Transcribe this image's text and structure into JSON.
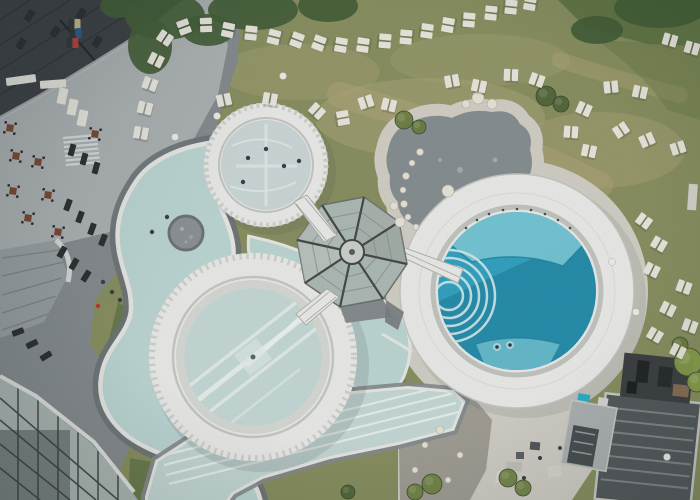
{
  "scene": {
    "title": "Aerial drone view of an alpine spa resort with circular thermal pools",
    "type": "aerial-photograph",
    "elements": "hotel roof and terrace, lazy river with stone island, three round pools, octagonal glass pavilion with footbridges, lap pool, pebble pond, gravel yard, service buildings, lawns with rows of sun loungers"
  },
  "palette": {
    "grassBase": "#8a9162",
    "grassLight": "#aaa67a",
    "grassDark": "#5e7546",
    "canopy": "#45613a",
    "worn": "#b3a97c",
    "gravelLight": "#d3d0c7",
    "gravelDark": "#a29f96",
    "pebbleDark": "#879092",
    "stoneWhite": "#e9e5da",
    "riverWater": "#bed8d5",
    "poolPale": "#c6dad7",
    "upperWater": "#cdd9d9",
    "rimWhite": "#ecedea",
    "rimShade": "#d2d3cf",
    "curbWhite": "#e9eae6",
    "paveDark": "#6f757a",
    "paveMid": "#878d90",
    "terraceLight": "#aeb3b4",
    "roofDark": "#3e4245",
    "roofTile": "#2c3033",
    "glassPane": "#aebbb6",
    "glassDark": "#454b4d",
    "frameDark": "#474c49",
    "deepPool": "#34a4c2",
    "deepLight": "#7ccad8",
    "deepShadow": "#16708c",
    "stepLine": "#d6ecee",
    "loungerWhite": "#eae8df",
    "loungerDark": "#2d3134",
    "tableBrown": "#7b4a32",
    "accentRed": "#c0392b",
    "accentBlue": "#2e5f8a",
    "accentTan": "#c9b98f",
    "accentTeal": "#29b2c9",
    "buildingRoof": "#565b5e",
    "buildingStripe": "#8d9296",
    "annexRoof": "#aeb3b4"
  },
  "counts": {
    "white_loungers": 50,
    "dark_loungers": 13,
    "bistro_tables": 8,
    "round_pools": 3,
    "bridges": 3
  },
  "canopy": [
    [
      165,
      16,
      40,
      24
    ],
    [
      253,
      10,
      45,
      20
    ],
    [
      328,
      6,
      30,
      16
    ],
    [
      660,
      8,
      46,
      20
    ],
    [
      150,
      46,
      22,
      28
    ],
    [
      118,
      6,
      18,
      12
    ],
    [
      597,
      30,
      26,
      14
    ],
    [
      208,
      30,
      26,
      16
    ]
  ],
  "white_loungers": [
    [
      141,
      133,
      10
    ],
    [
      145,
      108,
      14
    ],
    [
      150,
      84,
      20
    ],
    [
      156,
      60,
      26
    ],
    [
      165,
      38,
      34
    ],
    [
      184,
      27,
      70
    ],
    [
      206,
      25,
      88
    ],
    [
      228,
      30,
      -78
    ],
    [
      251,
      33,
      96
    ],
    [
      274,
      37,
      -76
    ],
    [
      297,
      40,
      110
    ],
    [
      319,
      43,
      -70
    ],
    [
      341,
      45,
      100
    ],
    [
      363,
      45,
      -82
    ],
    [
      385,
      41,
      95
    ],
    [
      406,
      37,
      -85
    ],
    [
      427,
      31,
      98
    ],
    [
      448,
      25,
      -80
    ],
    [
      469,
      20,
      95
    ],
    [
      491,
      13,
      -84
    ],
    [
      511,
      7,
      96
    ],
    [
      530,
      3,
      -80
    ],
    [
      452,
      81,
      -10
    ],
    [
      479,
      86,
      12
    ],
    [
      511,
      75,
      2
    ],
    [
      537,
      80,
      20
    ],
    [
      611,
      87,
      -6
    ],
    [
      640,
      92,
      12
    ],
    [
      670,
      40,
      16
    ],
    [
      692,
      48,
      16
    ],
    [
      584,
      109,
      24
    ],
    [
      571,
      132,
      4
    ],
    [
      589,
      151,
      12
    ],
    [
      621,
      130,
      -34
    ],
    [
      647,
      140,
      -24
    ],
    [
      678,
      148,
      -18
    ],
    [
      644,
      221,
      36
    ],
    [
      659,
      244,
      30
    ],
    [
      652,
      270,
      26
    ],
    [
      684,
      287,
      20
    ],
    [
      668,
      309,
      26
    ],
    [
      690,
      326,
      20
    ],
    [
      655,
      335,
      30
    ],
    [
      678,
      351,
      26
    ],
    [
      224,
      100,
      -12
    ],
    [
      270,
      99,
      10
    ],
    [
      317,
      111,
      42
    ],
    [
      343,
      118,
      80
    ],
    [
      366,
      102,
      -18
    ],
    [
      389,
      105,
      14
    ]
  ],
  "dark_loungers": [
    [
      72,
      150,
      15
    ],
    [
      84,
      159,
      15
    ],
    [
      96,
      168,
      15
    ],
    [
      68,
      205,
      20
    ],
    [
      80,
      217,
      20
    ],
    [
      92,
      229,
      20
    ],
    [
      103,
      240,
      22
    ],
    [
      62,
      252,
      30
    ],
    [
      74,
      264,
      30
    ],
    [
      86,
      276,
      32
    ],
    [
      18,
      332,
      70
    ],
    [
      32,
      344,
      64
    ],
    [
      46,
      356,
      58
    ]
  ],
  "bistro_tables": [
    [
      10,
      128
    ],
    [
      95,
      134
    ],
    [
      16,
      156
    ],
    [
      38,
      162
    ],
    [
      13,
      191
    ],
    [
      48,
      195
    ],
    [
      28,
      218
    ],
    [
      58,
      232
    ]
  ],
  "balls": [
    [
      283,
      76
    ],
    [
      217,
      116
    ],
    [
      175,
      137
    ],
    [
      636,
      312
    ],
    [
      612,
      262
    ],
    [
      667,
      457
    ]
  ],
  "stones": [
    [
      420,
      152,
      3.5
    ],
    [
      412,
      163,
      3
    ],
    [
      406,
      176,
      3.5
    ],
    [
      403,
      190,
      3
    ],
    [
      404,
      204,
      3.5
    ],
    [
      408,
      217,
      3
    ],
    [
      416,
      227,
      3
    ],
    [
      448,
      191,
      6
    ],
    [
      400,
      222,
      5
    ],
    [
      394,
      206,
      4
    ],
    [
      478,
      98,
      6
    ],
    [
      492,
      104,
      5
    ],
    [
      466,
      104,
      4
    ],
    [
      440,
      430,
      4
    ],
    [
      425,
      445,
      3
    ],
    [
      460,
      455,
      3
    ],
    [
      415,
      470,
      3
    ],
    [
      448,
      480,
      3
    ]
  ],
  "bushes": [
    [
      404,
      120,
      9,
      "#6e7f43"
    ],
    [
      419,
      127,
      7,
      "#6e7f43"
    ],
    [
      546,
      96,
      10,
      "#55683c"
    ],
    [
      561,
      104,
      8,
      "#55683c"
    ],
    [
      688,
      362,
      14,
      "#8aa04e"
    ],
    [
      697,
      382,
      10,
      "#8aa04e"
    ],
    [
      680,
      345,
      8,
      "#6e7f43"
    ],
    [
      432,
      484,
      10,
      "#748648"
    ],
    [
      415,
      492,
      8,
      "#748648"
    ],
    [
      348,
      492,
      7,
      "#55683c"
    ],
    [
      508,
      478,
      9,
      "#748648"
    ],
    [
      523,
      488,
      8,
      "#748648"
    ]
  ],
  "people": [
    [
      248,
      158,
      "#39424a"
    ],
    [
      266,
      149,
      "#39424a"
    ],
    [
      284,
      166,
      "#39424a"
    ],
    [
      243,
      182,
      "#39424a"
    ],
    [
      299,
      161,
      "#39424a"
    ],
    [
      152,
      232,
      "#39424a"
    ],
    [
      167,
      217,
      "#39424a"
    ],
    [
      497,
      347,
      "swim"
    ],
    [
      510,
      345,
      "swim"
    ],
    [
      103,
      282,
      "#39424a"
    ],
    [
      112,
      292,
      "#39424a"
    ],
    [
      120,
      300,
      "#39424a"
    ],
    [
      98,
      306,
      "#c0392b"
    ]
  ],
  "accent_loungers": [
    [
      76,
      24,
      "#c9b98f"
    ],
    [
      77,
      33,
      "#2e5f8a"
    ],
    [
      74,
      43,
      "#b8453a"
    ]
  ],
  "right_pool": {
    "railing_dots": [
      [
        466,
        228
      ],
      [
        477,
        220
      ],
      [
        489,
        214
      ],
      [
        503,
        210
      ],
      [
        517,
        209
      ],
      [
        531,
        210
      ],
      [
        545,
        214
      ],
      [
        558,
        220
      ],
      [
        570,
        228
      ]
    ]
  }
}
